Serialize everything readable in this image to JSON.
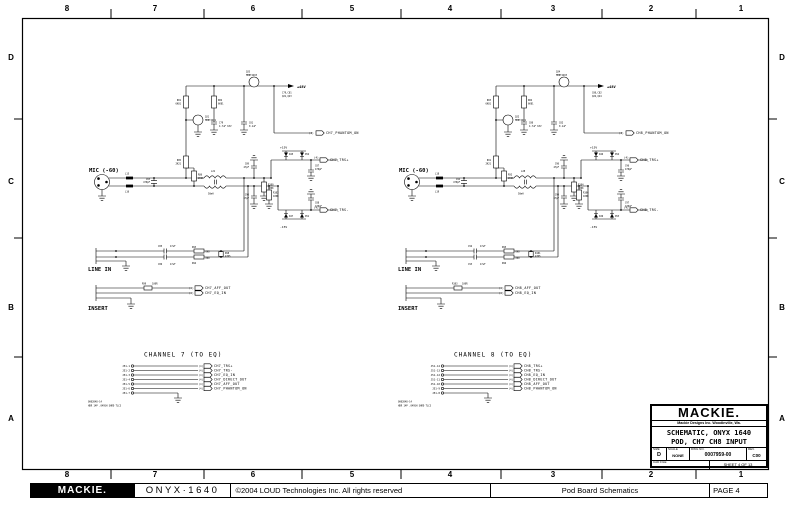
{
  "frame": {
    "top_zones": [
      "8",
      "7",
      "6",
      "5",
      "4",
      "3",
      "2",
      "1"
    ],
    "bottom_zones": [
      "8",
      "7",
      "6",
      "5",
      "4",
      "3",
      "2",
      "1"
    ],
    "left_zones": [
      "D",
      "C",
      "B",
      "A"
    ],
    "right_zones": [
      "D",
      "C",
      "B",
      "A"
    ]
  },
  "title_block": {
    "logo": "MACKIE.",
    "company": "Mackie Designs Inc.  Woodinville, Wa.",
    "title_line1": "SCHEMATIC, ONYX 1640",
    "title_line2": "POD, CH7 CH8 INPUT",
    "size_label": "SIZE",
    "size": "D",
    "scale_label": "SCALE",
    "scale": "NONE",
    "dwg_label": "DWG NO.",
    "dwg_no": "0007959-00",
    "rev_label": "REV.",
    "rev": "C00",
    "cad_label": "CAD FILE",
    "sheet": "SHEET 4 OF 13"
  },
  "footer": {
    "logo": "MACKIE.",
    "product": "ONYX·1640",
    "copyright": "©2004 LOUD Technologies Inc. All rights reserved",
    "doc_title": "Pod Board Schematics",
    "page": "PAGE 4"
  },
  "channels": [
    {
      "header": "CHANNEL 7 (TO EQ)",
      "mic_label": "MIC (-60)",
      "line_label": "LINE IN",
      "insert_label": "INSERT",
      "supply": {
        "p48": "+48V",
        "p15": "+15V",
        "m15": "-15V",
        "note1": "C79,C81",
        "note2": "Q21,Q23"
      },
      "ref": "(4)",
      "nets": {
        "trs_p": "CH7_TRS+",
        "trs_m": "CH7_TRS-",
        "aff_out": "CH7_AFF_OUT",
        "eq_in": "CH7_EQ_IN",
        "phantom": "CH7_PHANTOM_ON"
      },
      "parts": {
        "q1": "Q23",
        "q1v": "MMBT4403",
        "q2": "Q21",
        "q2v": "MMBT4401",
        "rp1": "R81",
        "rp1v": "6K81",
        "rp2": "R82",
        "rp2v": "6K81",
        "cp1": "C79",
        "cp1v": "4.7uF 63V",
        "cp2": "C81",
        "cp2v": "0.1uF",
        "l1": "L15",
        "l2": "L16",
        "cin": "C83",
        "cinv": "470pF",
        "r1": "R85",
        "r1v": "2K21",
        "r2": "R86",
        "r2v": "2K21",
        "xf": "L21",
        "xfv": "50mH",
        "chf1": "C89",
        "chf1v": "47pF",
        "rb1": "R100",
        "rb1v": "100K",
        "chf2": "C90",
        "chf2v": "47pF",
        "rb2": "R102",
        "rb2v": "100K",
        "d1": "D45",
        "d2": "D52",
        "d3": "D47",
        "d4": "D51",
        "ct1": "C87",
        "ct1v": "470pF",
        "ct2": "C88",
        "ct2v": "470pF",
        "cl1": "C85",
        "cl1v": "47uF",
        "cl2": "C86",
        "cl2v": "47uF",
        "rl1": "R93",
        "rl1v": "0K0",
        "rl2": "R94",
        "rl2v": "0K0",
        "rl3": "R98",
        "rl3v": "47K5",
        "ri1": "R99",
        "ri1v": "100R",
        "part_no": "0002048-14",
        "part_desc": "HDR 14P .049SH SHRD TLC3"
      },
      "pins": [
        {
          "pin": "J51-1",
          "ref": "(4)",
          "net": "CH7_TRS+"
        },
        {
          "pin": "J51-2",
          "ref": "(4)",
          "net": "CH7_TRS-"
        },
        {
          "pin": "J51-3",
          "ref": "(4)",
          "net": "CH7_EQ_IN"
        },
        {
          "pin": "J51-4",
          "ref": "(4)",
          "net": "CH7_DIRECT_OUT"
        },
        {
          "pin": "J51-5",
          "ref": "(4)",
          "net": "CH7_AFF_OUT"
        },
        {
          "pin": "J51-6",
          "ref": "(4)",
          "net": "CH7_PHANTOM_ON"
        },
        {
          "pin": "J51-7",
          "ref": "",
          "net": ""
        }
      ]
    },
    {
      "header": "CHANNEL 8 (TO EQ)",
      "mic_label": "MIC (-60)",
      "line_label": "LINE IN",
      "insert_label": "INSERT",
      "supply": {
        "p48": "+48V",
        "p15": "+15V",
        "m15": "-15V",
        "note1": "C80,C82",
        "note2": "Q22,Q24"
      },
      "ref": "(4)",
      "nets": {
        "trs_p": "CH8_TRS+",
        "trs_m": "CH8_TRS-",
        "aff_out": "CH8_AFF_OUT",
        "eq_in": "CH8_EQ_IN",
        "phantom": "CH8_PHANTOM_ON"
      },
      "parts": {
        "q1": "Q24",
        "q1v": "MMBT4403",
        "q2": "Q22",
        "q2v": "MMBT4401",
        "rp1": "R83",
        "rp1v": "6K81",
        "rp2": "R84",
        "rp2v": "6K81",
        "cp1": "C80",
        "cp1v": "4.7uF 63V",
        "cp2": "C82",
        "cp2v": "0.1uF",
        "l1": "L18",
        "l2": "L19",
        "cin": "C94",
        "cinv": "470pF",
        "r1": "R91",
        "r1v": "2K21",
        "r2": "R92",
        "r2v": "2K21",
        "xf": "L28",
        "xfv": "50mH",
        "chf1": "C98",
        "chf1v": "47pF",
        "rb1": "R104",
        "rb1v": "100K",
        "chf2": "C99",
        "chf2v": "47pF",
        "rb2": "R106",
        "rb2v": "100K",
        "d1": "D46",
        "d2": "D54",
        "d3": "D49",
        "d4": "D53",
        "ct1": "C96",
        "ct1v": "470pF",
        "ct2": "C97",
        "ct2v": "470pF",
        "cl1": "C92",
        "cl1v": "47uF",
        "cl2": "C93",
        "cl2v": "47uF",
        "rl1": "R95",
        "rl1v": "0K0",
        "rl2": "R96",
        "rl2v": "0K0",
        "rl3": "R101",
        "rl3v": "47K5",
        "ri1": "R103",
        "ri1v": "100R",
        "part_no": "0002048-14",
        "part_desc": "HDR 14P .049SH SHRD TLC3"
      },
      "pins": [
        {
          "pin": "J51-14",
          "ref": "(4)",
          "net": "CH8_TRS+"
        },
        {
          "pin": "J51-13",
          "ref": "(4)",
          "net": "CH8_TRS-"
        },
        {
          "pin": "J51-12",
          "ref": "(4)",
          "net": "CH8_EQ_IN"
        },
        {
          "pin": "J51-11",
          "ref": "(4)",
          "net": "CH8_DIRECT_OUT"
        },
        {
          "pin": "J51-10",
          "ref": "(4)",
          "net": "CH8_AFF_OUT"
        },
        {
          "pin": "J51-9",
          "ref": "(4)",
          "net": "CH8_PHANTOM_ON"
        },
        {
          "pin": "J51-8",
          "ref": "",
          "net": ""
        }
      ]
    }
  ]
}
